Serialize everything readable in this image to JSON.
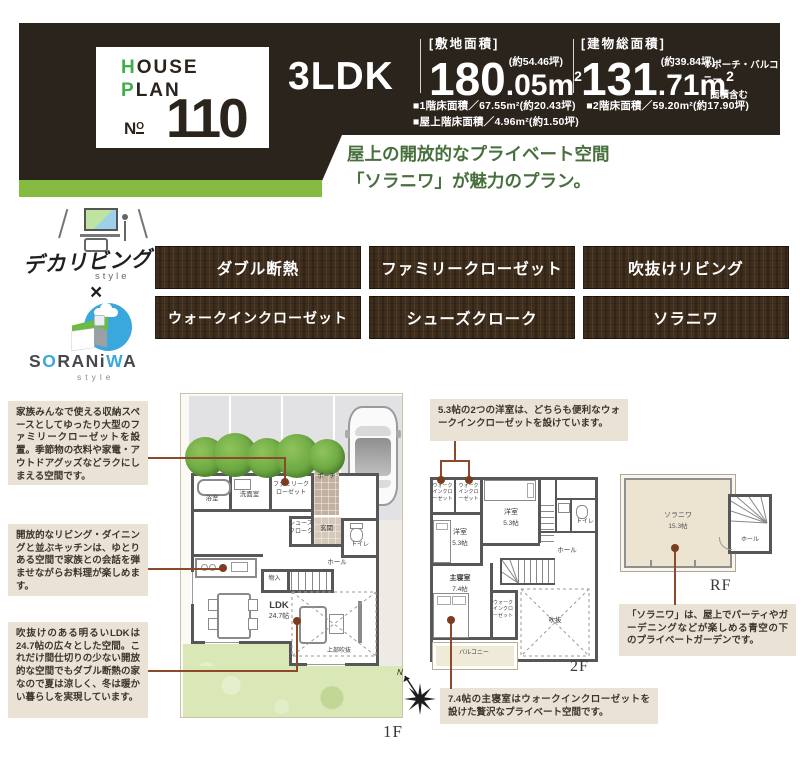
{
  "header": {
    "card": {
      "house_initial": "H",
      "house_rest": "OUSE",
      "plan_initial": "P",
      "plan_rest": "LAN",
      "no_n": "N",
      "no_o": "O",
      "number": "110"
    },
    "ldk": "3LDK",
    "site_area": {
      "label": "[敷地面積]",
      "tsubo": "(約54.46坪)",
      "int": "180",
      "dec": ".05m",
      "sup": "2"
    },
    "building_area": {
      "label": "[建物総面積]",
      "tsubo": "(約39.84坪)",
      "int": "131",
      "dec": ".71m",
      "sup": "2"
    },
    "note_line1": "※ポーチ・バルコニー",
    "note_line2": "面積含む",
    "floor_line1": "■1階床面積／67.55m²(約20.43坪)　■2階床面積／59.20m²(約17.90坪)",
    "floor_line2": "■屋上階床面積／4.96m²(約1.50坪)"
  },
  "tagline": {
    "line1": "屋上の開放的なプライベート空間",
    "line2": "「ソラニワ」が魅力のプラン。"
  },
  "logos": {
    "deka_text": "デカリビング",
    "deka_style": "style",
    "cross": "×",
    "sora_s": "S",
    "sora_o": "O",
    "sora_mid": "RANi",
    "sora_w": "W",
    "sora_a": "A",
    "sora_style": "style"
  },
  "tags": {
    "row1": [
      "ダブル断熱",
      "ファミリークローゼット",
      "吹抜けリビング"
    ],
    "row2": [
      "ウォークインクローゼット",
      "シューズクローク",
      "ソラニワ"
    ]
  },
  "callouts": {
    "family_closet": "家族みんなで使える収納スペースとしてゆったり大型のファミリークローゼットを設置。季節物の衣料や家電・アウトドアグッズなどラクにしまえる空間です。",
    "kitchen": "開放的なリビング・ダイニングと並ぶキッチンは、ゆとりある空間で家族との会話を弾ませながらお料理が楽しめます。",
    "ldk": "吹抜けのある明るいLDKは24.7帖の広々とした空間。これだけ間仕切りの少ない開放的な空間でもダブル断熱の家なので夏は涼しく、冬は暖かい暮らしを実現しています。",
    "bedrooms": "5.3帖の2つの洋室は、どちらも便利なウォークインクローゼットを設けています。",
    "soraniwa": "「ソラニワ」は、屋上でパーティやガーデニングなどが楽しめる青空の下のプライベートガーデンです。",
    "master": "7.4帖の主寝室はウォークインクローゼットを設けた贅沢なプライベート空間です。"
  },
  "floorplans": {
    "f1": {
      "floor_label": "1F",
      "ldk": "LDK",
      "ldk_size": "24.7帖",
      "bath": "浴室",
      "wash": "洗面室",
      "famiclo": "ファミリークローゼット",
      "porch": "ポーチ",
      "shoes": "シューズクローク",
      "genkan": "玄関",
      "toilet": "トイレ",
      "hall": "ホール",
      "storage": "物入",
      "void": "上部吹抜"
    },
    "f2": {
      "floor_label": "2F",
      "wic": "ウォークインクローゼット",
      "room": "洋室",
      "room_size": "5.3帖",
      "toilet": "トイレ",
      "hall": "ホール",
      "master": "主寝室",
      "master_size": "7.4帖",
      "void": "吹抜",
      "balcony": "バルコニー"
    },
    "rf": {
      "floor_label": "RF",
      "soraniwa": "ソラニワ",
      "size": "15.3帖",
      "hall": "ホール"
    },
    "compass_n": "N"
  }
}
